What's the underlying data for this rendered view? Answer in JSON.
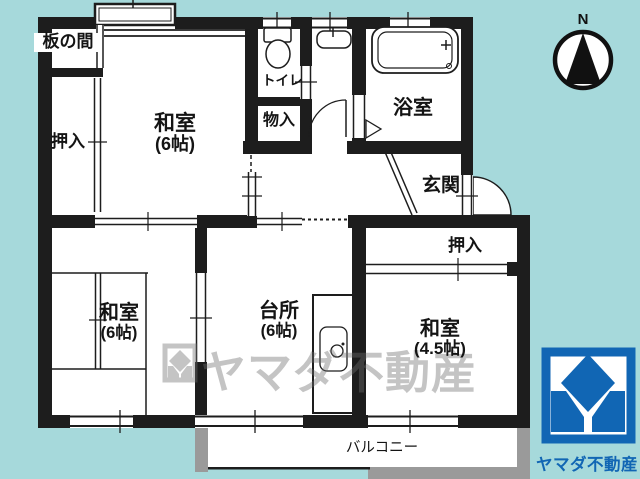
{
  "colors": {
    "background": "#a6d9db",
    "wall": "#1d1d1d",
    "logo_blue": "#1166b4",
    "watermark_gray": "#6e6e6e",
    "balcony_gray": "#9a9a9a"
  },
  "compass": {
    "label": "N"
  },
  "rooms": {
    "itanoma": {
      "label": "板の間"
    },
    "oshiire_tl": {
      "label": "押入"
    },
    "washitsu_top": {
      "label": "和室",
      "size": "(6帖)"
    },
    "toilet": {
      "label": "トイレ"
    },
    "monoire": {
      "label": "物入"
    },
    "bathroom": {
      "label": "浴室"
    },
    "genkan": {
      "label": "玄関"
    },
    "oshiire_right": {
      "label": "押入"
    },
    "washitsu_right": {
      "label": "和室",
      "size": "(4.5帖)"
    },
    "kitchen": {
      "label": "台所",
      "size": "(6帖)"
    },
    "washitsu_bl": {
      "label": "和室",
      "size": "(6帖)"
    },
    "balcony": {
      "label": "バルコニー"
    }
  },
  "watermark": {
    "text": "ヤマダ不動産"
  },
  "logo": {
    "text": "ヤマダ不動産"
  }
}
